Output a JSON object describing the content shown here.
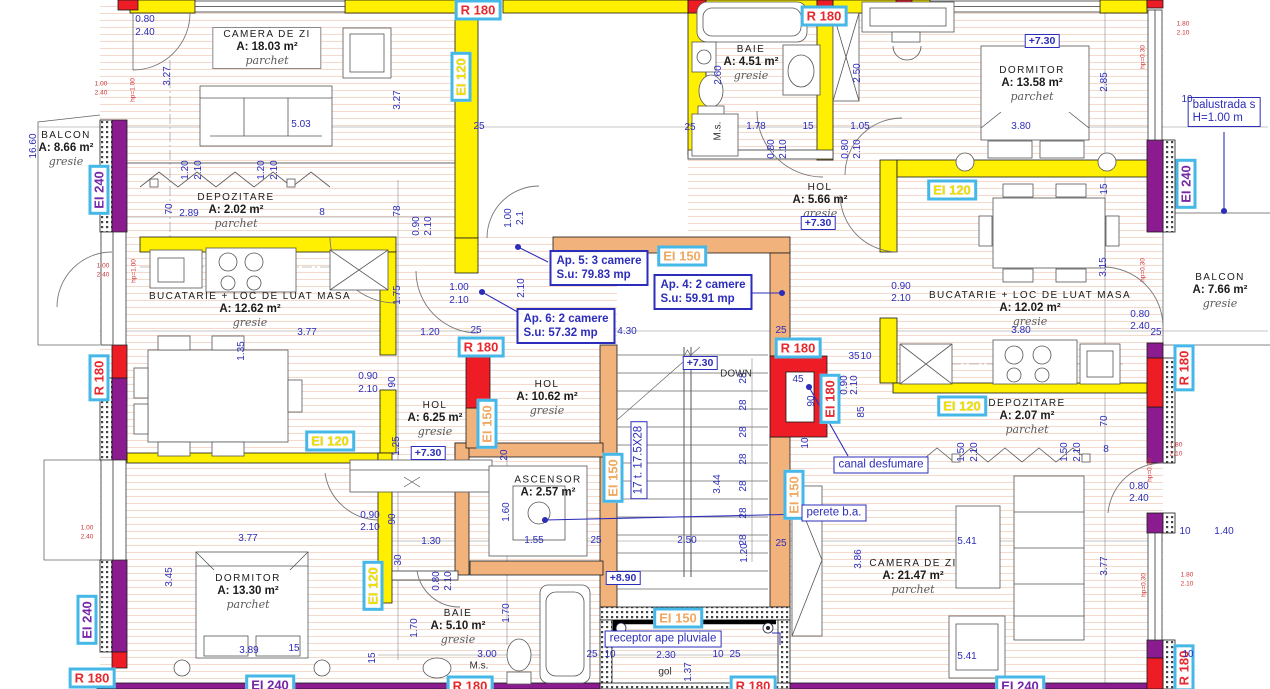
{
  "palette": {
    "r180": "#e8282d",
    "ei120": "#f0e000",
    "ei150": "#f0a860",
    "ei240": "#7527a8",
    "badge": "#45b8e8",
    "dim": "#2d2dbb",
    "wall_yellow": "#ffef00",
    "wall_purple": "#8a1c8f",
    "wall_red": "#ee1c25",
    "wall_orange": "#f2b27b"
  },
  "rooms": [
    {
      "name": "CAMERA DE ZI",
      "area": "A: 18.03 m²",
      "floor": "parchet",
      "x": 267,
      "y": 48,
      "boxed": true
    },
    {
      "name": "BALCON",
      "area": "A: 8.66 m²",
      "floor": "gresie",
      "x": 66,
      "y": 149
    },
    {
      "name": "DEPOZITARE",
      "area": "A: 2.02 m²",
      "floor": "parchet",
      "x": 236,
      "y": 211
    },
    {
      "name": "BUCATARIE + LOC DE LUAT MASA",
      "area": "A: 12.62 m²",
      "floor": "gresie",
      "x": 250,
      "y": 310
    },
    {
      "name": "HOL",
      "area": "A: 6.25 m²",
      "floor": "gresie",
      "x": 435,
      "y": 419
    },
    {
      "name": "HOL",
      "area": "A: 10.62 m²",
      "floor": "gresie",
      "x": 547,
      "y": 398
    },
    {
      "name": "BAIE",
      "area": "A: 4.51 m²",
      "floor": "gresie",
      "x": 751,
      "y": 63
    },
    {
      "name": "HOL",
      "area": "A: 5.66 m²",
      "floor": "gresie",
      "x": 820,
      "y": 201
    },
    {
      "name": "DORMITOR",
      "area": "A: 13.58 m²",
      "floor": "parchet",
      "x": 1032,
      "y": 84
    },
    {
      "name": "BALCON",
      "area": "A: 7.66 m²",
      "floor": "gresie",
      "x": 1220,
      "y": 291
    },
    {
      "name": "BUCATARIE + LOC DE LUAT MASA",
      "area": "A: 12.02 m²",
      "floor": "gresie",
      "x": 1030,
      "y": 309
    },
    {
      "name": "DEPOZITARE",
      "area": "A: 2.07 m²",
      "floor": "parchet",
      "x": 1027,
      "y": 417
    },
    {
      "name": "ASCENSOR",
      "area": "A: 2.57 m²",
      "x": 548,
      "y": 487
    },
    {
      "name": "DORMITOR",
      "area": "A: 13.30 m²",
      "floor": "parchet",
      "x": 248,
      "y": 592
    },
    {
      "name": "BAIE",
      "area": "A: 5.10 m²",
      "floor": "gresie",
      "x": 458,
      "y": 627
    },
    {
      "name": "CAMERA DE ZI",
      "area": "A: 21.47 m²",
      "floor": "parchet",
      "x": 913,
      "y": 577
    }
  ],
  "apartments": [
    {
      "line1": "Ap. 5: 3 camere",
      "line2": "S.u: 79.83 mp",
      "x": 599,
      "y": 268
    },
    {
      "line1": "Ap. 4: 2 camere",
      "line2": "S.u: 59.91 mp",
      "x": 703,
      "y": 292
    },
    {
      "line1": "Ap. 6: 2 camere",
      "line2": "S.u: 57.32 mp",
      "x": 566,
      "y": 326
    }
  ],
  "fire_labels": [
    {
      "t": "R 180",
      "c": "red",
      "o": "h",
      "x": 478,
      "y": 10
    },
    {
      "t": "R 180",
      "c": "red",
      "o": "h",
      "x": 824,
      "y": 16
    },
    {
      "t": "EI 120",
      "c": "yellow",
      "o": "v",
      "x": 461,
      "y": 77
    },
    {
      "t": "EI 240",
      "c": "purple",
      "o": "v",
      "x": 99,
      "y": 190
    },
    {
      "t": "EI 150",
      "c": "orange",
      "o": "h",
      "x": 682,
      "y": 256
    },
    {
      "t": "R 180",
      "c": "red",
      "o": "h",
      "x": 481,
      "y": 347
    },
    {
      "t": "R 180",
      "c": "red",
      "o": "h",
      "x": 798,
      "y": 348
    },
    {
      "t": "EI 150",
      "c": "orange",
      "o": "v",
      "x": 487,
      "y": 424
    },
    {
      "t": "EI 120",
      "c": "yellow",
      "o": "h",
      "x": 330,
      "y": 441
    },
    {
      "t": "EI 150",
      "c": "orange",
      "o": "v",
      "x": 613,
      "y": 478
    },
    {
      "t": "EI 150",
      "c": "orange",
      "o": "v",
      "x": 794,
      "y": 495
    },
    {
      "t": "EI 180",
      "c": "red",
      "o": "v",
      "x": 830,
      "y": 399
    },
    {
      "t": "EI 120",
      "c": "yellow",
      "o": "h",
      "x": 952,
      "y": 190
    },
    {
      "t": "EI 120",
      "c": "yellow",
      "o": "h",
      "x": 962,
      "y": 406
    },
    {
      "t": "EI 240",
      "c": "purple",
      "o": "v",
      "x": 1186,
      "y": 184
    },
    {
      "t": "R 180",
      "c": "red",
      "o": "v",
      "x": 1184,
      "y": 368
    },
    {
      "t": "R 180",
      "c": "red",
      "o": "v",
      "x": 1184,
      "y": 668
    },
    {
      "t": "EI 240",
      "c": "purple",
      "o": "v",
      "x": 87,
      "y": 620
    },
    {
      "t": "R 180",
      "c": "red",
      "o": "v",
      "x": 99,
      "y": 378
    },
    {
      "t": "R 180",
      "c": "red",
      "o": "h",
      "x": 92,
      "y": 678
    },
    {
      "t": "EI 240",
      "c": "purple",
      "o": "h",
      "x": 270,
      "y": 685
    },
    {
      "t": "R 180",
      "c": "red",
      "o": "h",
      "x": 470,
      "y": 686
    },
    {
      "t": "EI 150",
      "c": "orange",
      "o": "h",
      "x": 678,
      "y": 618
    },
    {
      "t": "R 180",
      "c": "red",
      "o": "h",
      "x": 753,
      "y": 686
    },
    {
      "t": "EI 240",
      "c": "purple",
      "o": "h",
      "x": 1020,
      "y": 686
    },
    {
      "t": "EI 120",
      "c": "yellow",
      "o": "v",
      "x": 373,
      "y": 586
    }
  ],
  "boxed_notes": [
    {
      "line1": "canal desfumare",
      "x": 881,
      "y": 465
    },
    {
      "line1": "perete b.a.",
      "x": 834,
      "y": 513
    },
    {
      "line1": "receptor ape pluviale",
      "x": 663,
      "y": 639
    },
    {
      "line1": "balustrada s",
      "line2": "H=1.00 m",
      "x": 1224,
      "y": 112
    },
    {
      "line1": "17 t. 17.5X28",
      "x": 639,
      "y": 460,
      "r": 1
    }
  ],
  "levels": [
    {
      "t": "+7.30",
      "x": 1042,
      "y": 41
    },
    {
      "t": "+7.30",
      "x": 818,
      "y": 223
    },
    {
      "t": "+7.30",
      "x": 700,
      "y": 363
    },
    {
      "t": "+7.30",
      "x": 428,
      "y": 453
    },
    {
      "t": "+8.90",
      "x": 623,
      "y": 578
    }
  ],
  "plain_notes": [
    {
      "t": "M.s.",
      "x": 718,
      "y": 131,
      "r": 1
    },
    {
      "t": "M.s.",
      "x": 479,
      "y": 666
    },
    {
      "t": "gol",
      "x": 665,
      "y": 672
    },
    {
      "t": "DOWN",
      "x": 736,
      "y": 374
    }
  ],
  "dimensions": [
    {
      "t": "0.80",
      "x": 145,
      "y": 20
    },
    {
      "t": "2.40",
      "x": 145,
      "y": 33
    },
    {
      "t": "3.27",
      "x": 168,
      "y": 76,
      "r": 1
    },
    {
      "t": "16.60",
      "x": 34,
      "y": 146,
      "r": 1
    },
    {
      "t": "5.03",
      "x": 301,
      "y": 125
    },
    {
      "t": "25",
      "x": 479,
      "y": 127
    },
    {
      "t": "25",
      "x": 690,
      "y": 128
    },
    {
      "t": "1.78",
      "x": 756,
      "y": 127
    },
    {
      "t": "15",
      "x": 808,
      "y": 127
    },
    {
      "t": "1.05",
      "x": 860,
      "y": 127
    },
    {
      "t": "3.80",
      "x": 1021,
      "y": 127
    },
    {
      "t": "2.85",
      "x": 1105,
      "y": 82,
      "r": 1
    },
    {
      "t": "2.50",
      "x": 858,
      "y": 73,
      "r": 1
    },
    {
      "t": "2.60",
      "x": 719,
      "y": 75,
      "r": 1
    },
    {
      "t": "3.27",
      "x": 398,
      "y": 100,
      "r": 1
    },
    {
      "t": "1.20",
      "x": 186,
      "y": 170,
      "r": 1
    },
    {
      "t": "2.10",
      "x": 199,
      "y": 170,
      "r": 1
    },
    {
      "t": "1.20",
      "x": 262,
      "y": 170,
      "r": 1
    },
    {
      "t": "2.10",
      "x": 275,
      "y": 170,
      "r": 1
    },
    {
      "t": "2.89",
      "x": 189,
      "y": 214
    },
    {
      "t": "70",
      "x": 170,
      "y": 209,
      "r": 1
    },
    {
      "t": "8",
      "x": 322,
      "y": 213
    },
    {
      "t": "78",
      "x": 398,
      "y": 211,
      "r": 1
    },
    {
      "t": "0.90",
      "x": 417,
      "y": 226,
      "r": 1
    },
    {
      "t": "2.10",
      "x": 429,
      "y": 226,
      "r": 1
    },
    {
      "t": "1.00",
      "x": 509,
      "y": 218,
      "r": 1
    },
    {
      "t": "2.1",
      "x": 521,
      "y": 218,
      "r": 1
    },
    {
      "t": "0.80",
      "x": 772,
      "y": 149,
      "r": 1
    },
    {
      "t": "2.10",
      "x": 784,
      "y": 149,
      "r": 1
    },
    {
      "t": "0.80",
      "x": 846,
      "y": 149,
      "r": 1
    },
    {
      "t": "2.10",
      "x": 858,
      "y": 149,
      "r": 1
    },
    {
      "t": "15",
      "x": 1105,
      "y": 189,
      "r": 1
    },
    {
      "t": "1.00",
      "x": 459,
      "y": 288
    },
    {
      "t": "2.10",
      "x": 459,
      "y": 301
    },
    {
      "t": "2.10",
      "x": 522,
      "y": 288,
      "r": 1
    },
    {
      "t": "1.75",
      "x": 398,
      "y": 295,
      "r": 1
    },
    {
      "t": "1.20",
      "x": 430,
      "y": 333
    },
    {
      "t": "25",
      "x": 476,
      "y": 331
    },
    {
      "t": "4.30",
      "x": 627,
      "y": 332
    },
    {
      "t": "25",
      "x": 781,
      "y": 331
    },
    {
      "t": "3.77",
      "x": 307,
      "y": 333
    },
    {
      "t": "0.90",
      "x": 901,
      "y": 287
    },
    {
      "t": "2.10",
      "x": 901,
      "y": 299
    },
    {
      "t": "3.15",
      "x": 1104,
      "y": 267,
      "r": 1
    },
    {
      "t": "0.80",
      "x": 1140,
      "y": 315
    },
    {
      "t": "2.40",
      "x": 1140,
      "y": 327
    },
    {
      "t": "25",
      "x": 1156,
      "y": 333
    },
    {
      "t": "3.80",
      "x": 1021,
      "y": 331
    },
    {
      "t": "1.35",
      "x": 242,
      "y": 351,
      "r": 1
    },
    {
      "t": "90",
      "x": 393,
      "y": 382,
      "r": 1
    },
    {
      "t": "0.90",
      "x": 368,
      "y": 377
    },
    {
      "t": "2.10",
      "x": 368,
      "y": 390
    },
    {
      "t": "35",
      "x": 854,
      "y": 357
    },
    {
      "t": "10",
      "x": 866,
      "y": 357
    },
    {
      "t": "45",
      "x": 798,
      "y": 380
    },
    {
      "t": "90",
      "x": 812,
      "y": 401,
      "r": 1
    },
    {
      "t": "0.90",
      "x": 845,
      "y": 385,
      "r": 1
    },
    {
      "t": "2.10",
      "x": 855,
      "y": 385,
      "r": 1
    },
    {
      "t": "85",
      "x": 862,
      "y": 412,
      "r": 1
    },
    {
      "t": "10",
      "x": 806,
      "y": 443,
      "r": 1
    },
    {
      "t": "28",
      "x": 744,
      "y": 378,
      "r": 1
    },
    {
      "t": "28",
      "x": 744,
      "y": 405,
      "r": 1
    },
    {
      "t": "28",
      "x": 744,
      "y": 432,
      "r": 1
    },
    {
      "t": "28",
      "x": 744,
      "y": 459,
      "r": 1
    },
    {
      "t": "28",
      "x": 744,
      "y": 486,
      "r": 1
    },
    {
      "t": "28",
      "x": 744,
      "y": 513,
      "r": 1
    },
    {
      "t": "28",
      "x": 744,
      "y": 540,
      "r": 1
    },
    {
      "t": "3.44",
      "x": 718,
      "y": 484,
      "r": 1
    },
    {
      "t": "1.20",
      "x": 745,
      "y": 553,
      "r": 1
    },
    {
      "t": "70",
      "x": 1105,
      "y": 421,
      "r": 1
    },
    {
      "t": "1.50",
      "x": 962,
      "y": 452,
      "r": 1
    },
    {
      "t": "2.10",
      "x": 975,
      "y": 452,
      "r": 1
    },
    {
      "t": "1.50",
      "x": 1065,
      "y": 452,
      "r": 1
    },
    {
      "t": "2.10",
      "x": 1078,
      "y": 452,
      "r": 1
    },
    {
      "t": "8",
      "x": 1106,
      "y": 450
    },
    {
      "t": "1.25",
      "x": 397,
      "y": 446,
      "r": 1
    },
    {
      "t": "20",
      "x": 505,
      "y": 455,
      "r": 1
    },
    {
      "t": "1.60",
      "x": 507,
      "y": 512,
      "r": 1
    },
    {
      "t": "90",
      "x": 393,
      "y": 519,
      "r": 1
    },
    {
      "t": "0.90",
      "x": 370,
      "y": 516
    },
    {
      "t": "2.10",
      "x": 370,
      "y": 528
    },
    {
      "t": "1.55",
      "x": 534,
      "y": 541
    },
    {
      "t": "25",
      "x": 596,
      "y": 541
    },
    {
      "t": "2.50",
      "x": 687,
      "y": 541
    },
    {
      "t": "25",
      "x": 781,
      "y": 544
    },
    {
      "t": "1.30",
      "x": 431,
      "y": 542
    },
    {
      "t": "5.41",
      "x": 967,
      "y": 542
    },
    {
      "t": "3.86",
      "x": 859,
      "y": 559,
      "r": 1
    },
    {
      "t": "3.77",
      "x": 1105,
      "y": 566,
      "r": 1
    },
    {
      "t": "3.45",
      "x": 170,
      "y": 577,
      "r": 1
    },
    {
      "t": "0.80",
      "x": 437,
      "y": 581,
      "r": 1
    },
    {
      "t": "2.10",
      "x": 449,
      "y": 581,
      "r": 1
    },
    {
      "t": "1.70",
      "x": 507,
      "y": 613,
      "r": 1
    },
    {
      "t": "1.70",
      "x": 415,
      "y": 628,
      "r": 1
    },
    {
      "t": "30",
      "x": 399,
      "y": 560,
      "r": 1
    },
    {
      "t": "3.77",
      "x": 248,
      "y": 539
    },
    {
      "t": "0.80",
      "x": 1139,
      "y": 487
    },
    {
      "t": "2.40",
      "x": 1139,
      "y": 499
    },
    {
      "t": "10",
      "x": 1185,
      "y": 532
    },
    {
      "t": "1.40",
      "x": 1224,
      "y": 532
    },
    {
      "t": "3.89",
      "x": 249,
      "y": 651
    },
    {
      "t": "15",
      "x": 294,
      "y": 649
    },
    {
      "t": "15",
      "x": 373,
      "y": 658,
      "r": 1
    },
    {
      "t": "3.00",
      "x": 487,
      "y": 655
    },
    {
      "t": "2.30",
      "x": 666,
      "y": 656
    },
    {
      "t": "10",
      "x": 610,
      "y": 655
    },
    {
      "t": "10",
      "x": 718,
      "y": 655
    },
    {
      "t": "25",
      "x": 592,
      "y": 655
    },
    {
      "t": "25",
      "x": 735,
      "y": 655
    },
    {
      "t": "5.41",
      "x": 967,
      "y": 657
    },
    {
      "t": "1.37",
      "x": 689,
      "y": 672,
      "r": 1
    },
    {
      "t": "10",
      "x": 1188,
      "y": 655
    },
    {
      "t": "10",
      "x": 1187,
      "y": 100
    }
  ],
  "red_notes": [
    {
      "t": "1.00",
      "x": 101,
      "y": 84
    },
    {
      "t": "2.40",
      "x": 101,
      "y": 93
    },
    {
      "t": "hp=1.00",
      "x": 133,
      "y": 90,
      "r": 1
    },
    {
      "t": "1.00",
      "x": 103,
      "y": 266
    },
    {
      "t": "2.40",
      "x": 103,
      "y": 275
    },
    {
      "t": "hp=1.00",
      "x": 134,
      "y": 271,
      "r": 1
    },
    {
      "t": "1.00",
      "x": 87,
      "y": 528
    },
    {
      "t": "2.40",
      "x": 87,
      "y": 537
    },
    {
      "t": "1.80",
      "x": 1183,
      "y": 24
    },
    {
      "t": "2.10",
      "x": 1183,
      "y": 33
    },
    {
      "t": "hp=0.30",
      "x": 1143,
      "y": 57,
      "r": 1
    },
    {
      "t": "hp=0.30",
      "x": 1143,
      "y": 270,
      "r": 1
    },
    {
      "t": "1.80",
      "x": 1176,
      "y": 445
    },
    {
      "t": "2.10",
      "x": 1176,
      "y": 454
    },
    {
      "t": "hp=0.30",
      "x": 1150,
      "y": 470,
      "r": 1
    },
    {
      "t": "1.80",
      "x": 1187,
      "y": 575
    },
    {
      "t": "2.10",
      "x": 1187,
      "y": 584
    },
    {
      "t": "hp=0.30",
      "x": 1144,
      "y": 585,
      "r": 1
    }
  ]
}
